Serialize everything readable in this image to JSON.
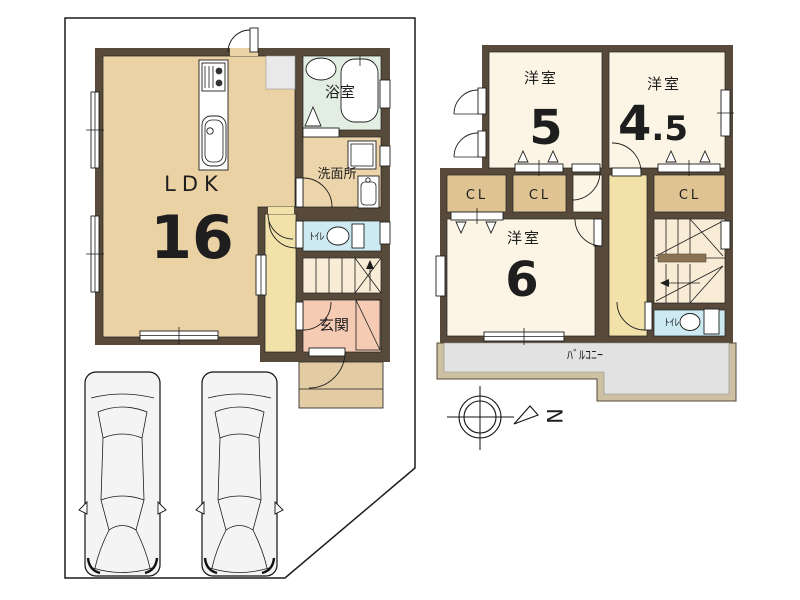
{
  "floor1": {
    "ldk_label": "LDK",
    "ldk_size": "16",
    "bath_label": "浴室",
    "washroom_label": "洗面所",
    "toilet_label": "ﾄｲﾚ",
    "entrance_label": "玄関"
  },
  "floor2": {
    "room5_label": "洋室",
    "room5_size": "5",
    "room45_label": "洋室",
    "room45_size_int": "4",
    "room45_size_dec": ".5",
    "room6_label": "洋室",
    "room6_size": "6",
    "closet1_label": "CL",
    "closet2_label": "CL",
    "closet3_label": "CL",
    "toilet_label": "ﾄｲﾚ",
    "balcony_label": "ﾊﾞﾙｺﾆｰ"
  },
  "compass": {
    "north_label": "N"
  },
  "colors": {
    "wall": "#584a3a",
    "ldk_floor": "#ead2a4",
    "bath_floor": "#e3eee3",
    "washroom_floor": "#ecd5ab",
    "toilet_floor": "#cdeaf3",
    "hall_floor": "#f2e2aa",
    "stairs_floor": "#f8ecd6",
    "entrance_floor": "#f5cbb3",
    "porch": "#e3cca4",
    "room_floor": "#fcf5e6",
    "closet_floor": "#dfc392",
    "balcony_floor": "#e2e2e2",
    "balcony_band": "#cec1a3",
    "appliance_gray": "#e9e9e9",
    "car_fill": "#f4f4f4",
    "handrail": "#8a7254"
  }
}
